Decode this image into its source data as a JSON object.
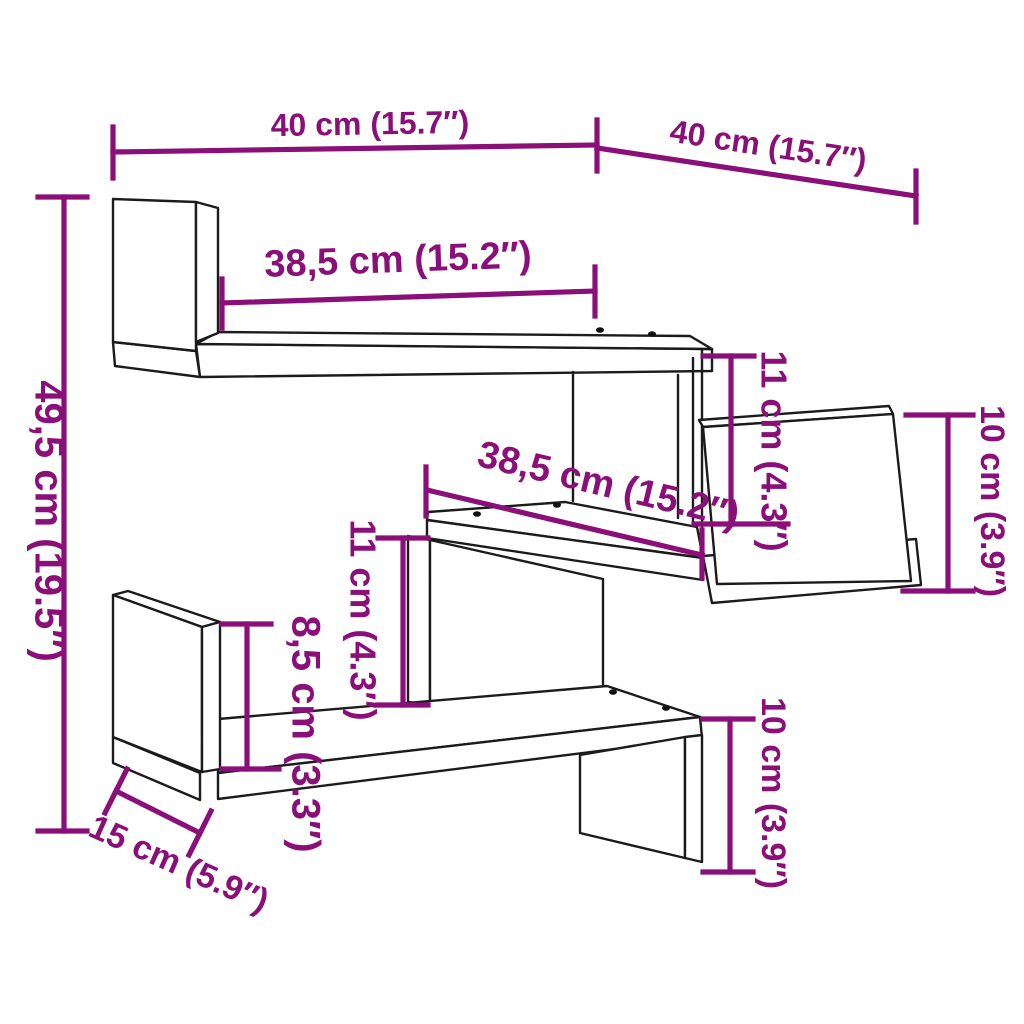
{
  "diagram": {
    "colors": {
      "background": "#ffffff",
      "outline": "#1b1b1b",
      "dimension": "#8a0f78"
    },
    "labels": {
      "width_left": "40 cm (15.7″)",
      "width_right": "40 cm (15.7″)",
      "shelf_top_length": "38,5 cm (15.2″)",
      "total_height": "49,5 cm (19.5″)",
      "gap_top_right": "11 cm (4.3″)",
      "panel_right_height": "10 cm (3.9″)",
      "shelf_middle_length": "38,5 cm (15.2″)",
      "gap_middle": "11 cm (4.3″)",
      "panel_left_height": "8,5 cm (3.3″)",
      "shelf_depth": "15 cm (5.9″)",
      "panel_bottom_height": "10 cm (3.9″)"
    }
  }
}
